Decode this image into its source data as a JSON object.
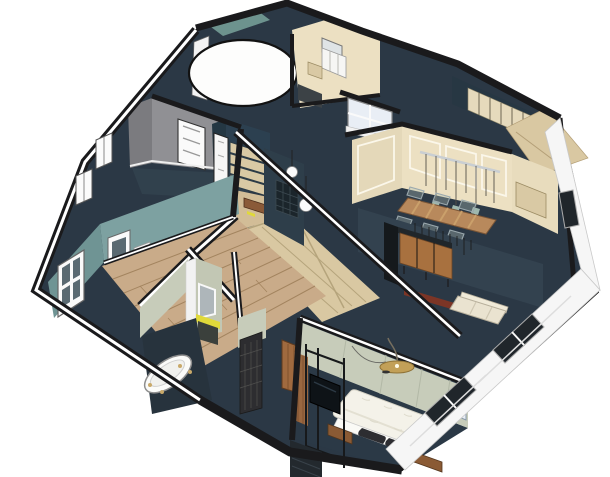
{
  "scene": {
    "description": "3D isometric cutaway (dollhouse) render of an apartment floor plan, SketchUp style, on a white background",
    "view": "aerial isometric, walls cut horizontally with white caps and black cores"
  },
  "colors": {
    "background": "#ffffff",
    "wall_cut": "#1a1a1c",
    "wall_cap": "#ffffff",
    "slab": "#2b3845",
    "navy_floor": "#2b3946",
    "navy_wall": "#33424f",
    "spine_wall": "#2e3e4a",
    "teal_wall": "#7da1a1",
    "teal_wall_dark": "#6f9494",
    "teal_accent": "#6d938e",
    "sage_wall": "#c7ccba",
    "sage_wall_dark": "#c2c7b4",
    "gray_wall": "#909094",
    "gray_wall_dark": "#7b7b7f",
    "cream_wall": "#ece0c2",
    "cream_wall_dark": "#e4d8b9",
    "cream_panel": "#e8dcbd",
    "wardrobe_doors": "#e6dabc",
    "dark_teal_wall": "#2c4050",
    "dark_teal_side": "#243743",
    "wood_floor": "#c9ab89",
    "wood_seam": "#a3845f",
    "parquet": "#d9c8a2",
    "parquet_seam": "#b5a47c",
    "study_floor": "#d2bd97",
    "shelf": "#d9c9a4",
    "table_wood": "#b8895c",
    "sideboard_wood": "#a8713f",
    "stain_wood": "#8a5a34",
    "bench_wood": "#8a5a38",
    "door_wood": "#a06a3f",
    "panel_wood": "#996740",
    "red_console": "#7c3526",
    "brass": "#c2a058",
    "yellow_accent": "#e0d93a",
    "white_fixture": "#f7f6f2",
    "duvet": "#f4f2e9",
    "pillow": "#2d2d31",
    "sofa": "#eae3d0",
    "mirror_glass": "#aeb6ba",
    "mosaic": "#2d2d30",
    "glass": "#e9eef5",
    "window_pane": "#5a6a72",
    "facade": "#f6f6f6",
    "facade_window": "#20262b",
    "tv_screen": "#0e1317",
    "dresser": "#23292e",
    "radiator": "#f2f2f2",
    "round_room": "#fdfdfc",
    "chair_ghost": "#aebfb8",
    "rail_metal": "#c9ced2"
  },
  "rooms": [
    {
      "id": "circular-room",
      "name": "Circular room volume",
      "features": [
        "white cylinder cut at ceiling",
        "teal accent wall behind"
      ]
    },
    {
      "id": "kitchenette",
      "name": "Kitchenette / utility",
      "features": [
        "white upper cabinets",
        "window",
        "tan counter",
        "dark appliance panel"
      ]
    },
    {
      "id": "wardrobe",
      "name": "Dressing room",
      "features": [
        "cream sliding wardrobe doors",
        "dark teal walls",
        "wood floor"
      ]
    },
    {
      "id": "gray-office",
      "name": "Gray room (office)",
      "features": [
        "gray walls",
        "white paneled door",
        "two facade windows",
        "dark slate floor"
      ]
    },
    {
      "id": "study",
      "name": "Study nook / entry",
      "features": [
        "dark teal walls",
        "tan bookshelf",
        "white glazed door",
        "wood floor",
        "brown bench",
        "yellow accent"
      ]
    },
    {
      "id": "dining",
      "name": "Dining room",
      "features": [
        "cream paneled walls with white trim",
        "long plank wood table",
        "six translucent ghost chairs",
        "linear pendant rail with glass shades",
        "window"
      ]
    },
    {
      "id": "lounge",
      "name": "Lounge / sitting room",
      "features": [
        "navy walls",
        "wood sideboard",
        "dark wall panel",
        "red console",
        "cream sofa",
        "row of wall hooks"
      ]
    },
    {
      "id": "living",
      "name": "Living room",
      "features": [
        "teal walls",
        "wide plank wood floor",
        "tall white window",
        "radiator"
      ]
    },
    {
      "id": "hallway",
      "name": "Hallway",
      "features": [
        "parquet floor",
        "two white sphere pendants",
        "dark mesh screen"
      ]
    },
    {
      "id": "bathroom",
      "name": "Bathroom",
      "features": [
        "white clawfoot bathtub",
        "vanity with yellow top",
        "framed mirror",
        "shower with dark mosaic tile",
        "wood toilet door",
        "sage walls"
      ]
    },
    {
      "id": "bedroom",
      "name": "Master bedroom",
      "features": [
        "white duvet double bed",
        "two dark pillows",
        "two wood nightstands",
        "brass arc floor lamp",
        "glass partition with TV",
        "dark dresser",
        "sage walls",
        "window"
      ]
    },
    {
      "id": "exterior",
      "name": "Exterior facade",
      "features": [
        "white plastered walls",
        "recessed dark windows"
      ]
    }
  ]
}
